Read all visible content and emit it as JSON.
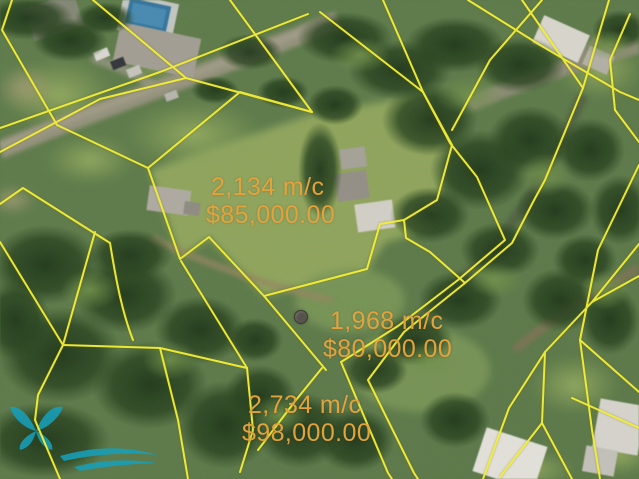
{
  "map": {
    "parcels": [
      {
        "area": "2,134 m/c",
        "price": "$85,000.00"
      },
      {
        "area": "1,968 m/c",
        "price": "$80,000.00"
      },
      {
        "area": "2,734 m/c",
        "price": "$98,000.00"
      }
    ],
    "colors": {
      "boundary_line": "#f4f038",
      "label_text": "#e2a33c",
      "marker_dot": "#56534c",
      "watermark": "#17a0ba"
    }
  }
}
